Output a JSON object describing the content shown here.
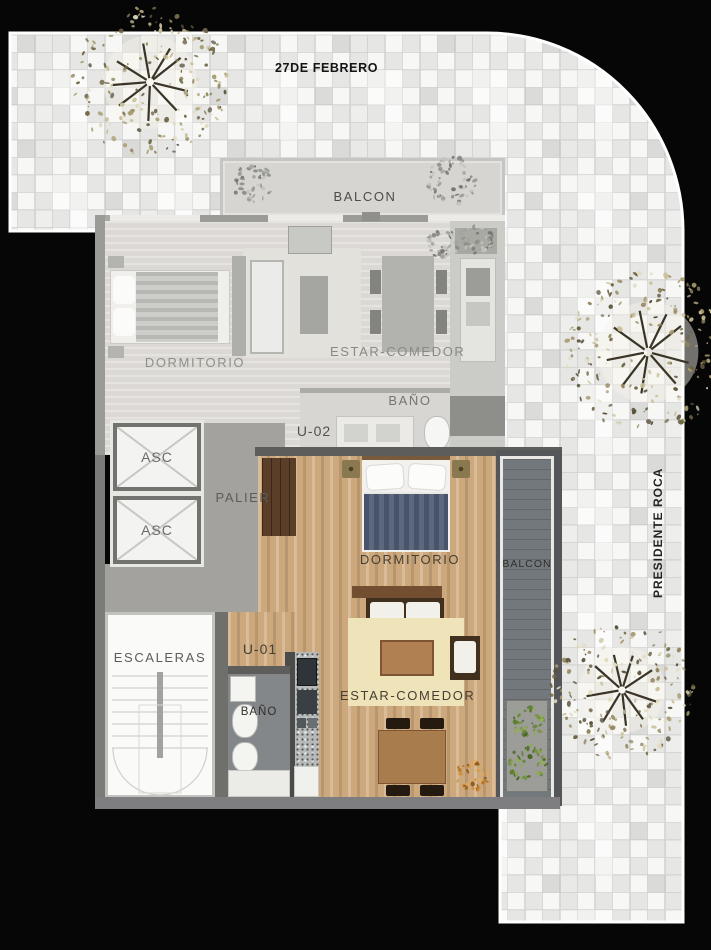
{
  "streets": {
    "top": "27DE FEBRERO",
    "right": "PRESIDENTE ROCA"
  },
  "units": {
    "u02": {
      "id": "U-02",
      "balcony": "BALCON",
      "bedroom": "DORMITORIO",
      "living": "ESTAR-COMEDOR",
      "bathroom": "BAÑO"
    },
    "u01": {
      "id": "U-01",
      "bedroom": "DORMITORIO",
      "living": "ESTAR-COMEDOR",
      "bathroom": "BAÑO",
      "balcony": "BALCON"
    }
  },
  "core": {
    "elevator_1": "ASC",
    "elevator_2": "ASC",
    "landing": "PALIER",
    "stairs": "ESCALERAS"
  },
  "colors": {
    "background": "#060606",
    "tile_light": "#f7f7f6",
    "tile_dark": "#e6e6e4",
    "grout": "#d4d4d2",
    "faded_floor": "#dcd9d5",
    "wood": "#cda87c",
    "duvet": "#49546b",
    "rug": "#efe3ba",
    "balcony_floor": "#73787c",
    "palier_floor": "#a3a29f",
    "wall": "#6f6f6c",
    "tree_khaki": "#9a8d5e",
    "bush_green": "#6e8d3a",
    "plant_orange": "#c07a2c"
  }
}
